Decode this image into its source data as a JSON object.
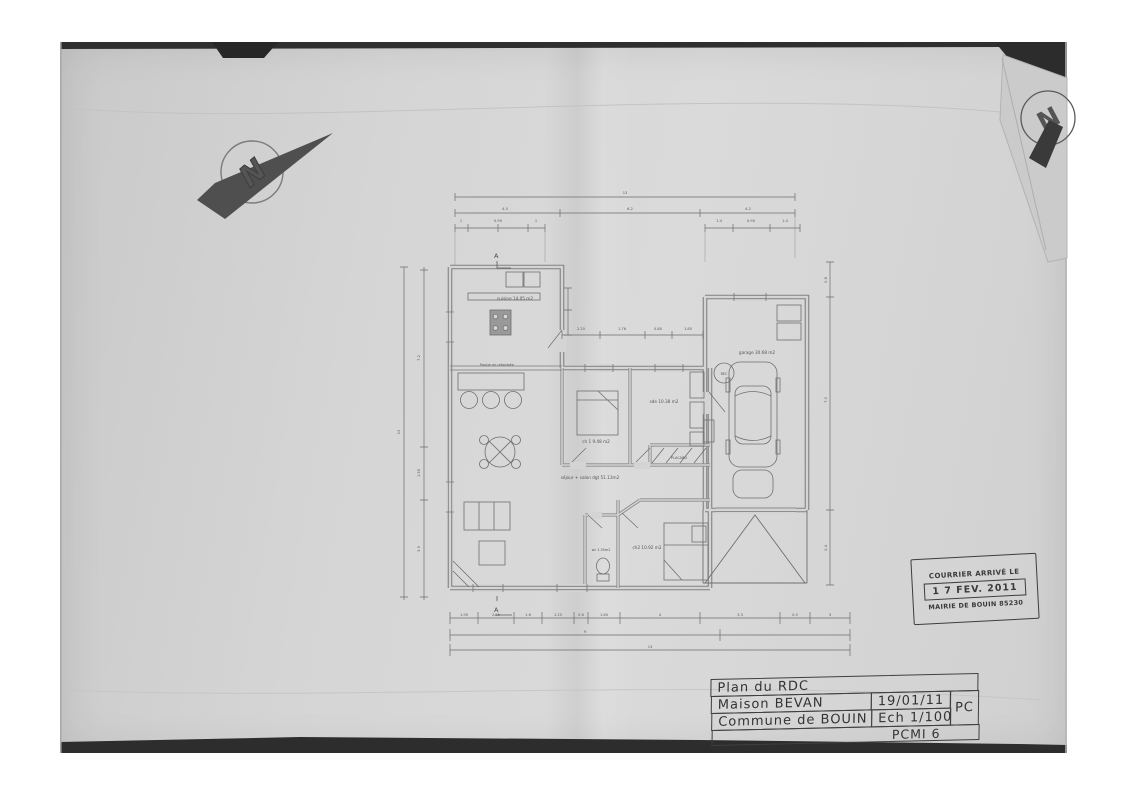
{
  "north": {
    "letter": "N"
  },
  "rooms": {
    "cuisine": "cuisine 14.05 m2",
    "beam": "Poutre en retombée",
    "sejour": "séjour + salon dgt 51.13m2",
    "ch1": "ch 1  9.48 m2",
    "sde": "sde 10.38 m2",
    "placard": "PLACARD",
    "ch2": "ch2 10.92 m2",
    "wc": "wc 1.55m2",
    "garage": "garage 30.68 m2",
    "rec": "REC"
  },
  "annotations": {
    "section": "A"
  },
  "dims": {
    "top": [
      "13",
      "4.5",
      "6.2",
      "4.2",
      "1",
      "0.90",
      "1",
      "1.4",
      "0.90",
      "1.4"
    ],
    "left": [
      "13",
      "7.2",
      "1.55",
      "3.9"
    ],
    "right": [
      "0.8",
      "7.0",
      "2.4"
    ],
    "bottom": [
      "1.90",
      "2.25",
      "1.6",
      "1.25",
      "0.6",
      "1.60",
      "4",
      "3.3",
      "0.5",
      "3",
      "9",
      "13"
    ],
    "terrace": [
      "2.25",
      "1.76",
      "0.80",
      "1.85"
    ]
  },
  "stamp": {
    "header": "COURRIER ARRIVÉ LE",
    "date": "1 7 FEV. 2011",
    "footer": "MAIRIE DE BOUIN 85230"
  },
  "title_block": {
    "line1": "Plan du RDC",
    "owner": "Maison BEVAN",
    "date": "19/01/11",
    "type": "PC",
    "commune": "Commune de BOUIN",
    "scale": "Ech 1/100",
    "ref": "PCMI 6"
  },
  "colors": {
    "paper": "#d4d4d4",
    "ink": "#555555",
    "dark_edge": "#2d2d2d"
  }
}
